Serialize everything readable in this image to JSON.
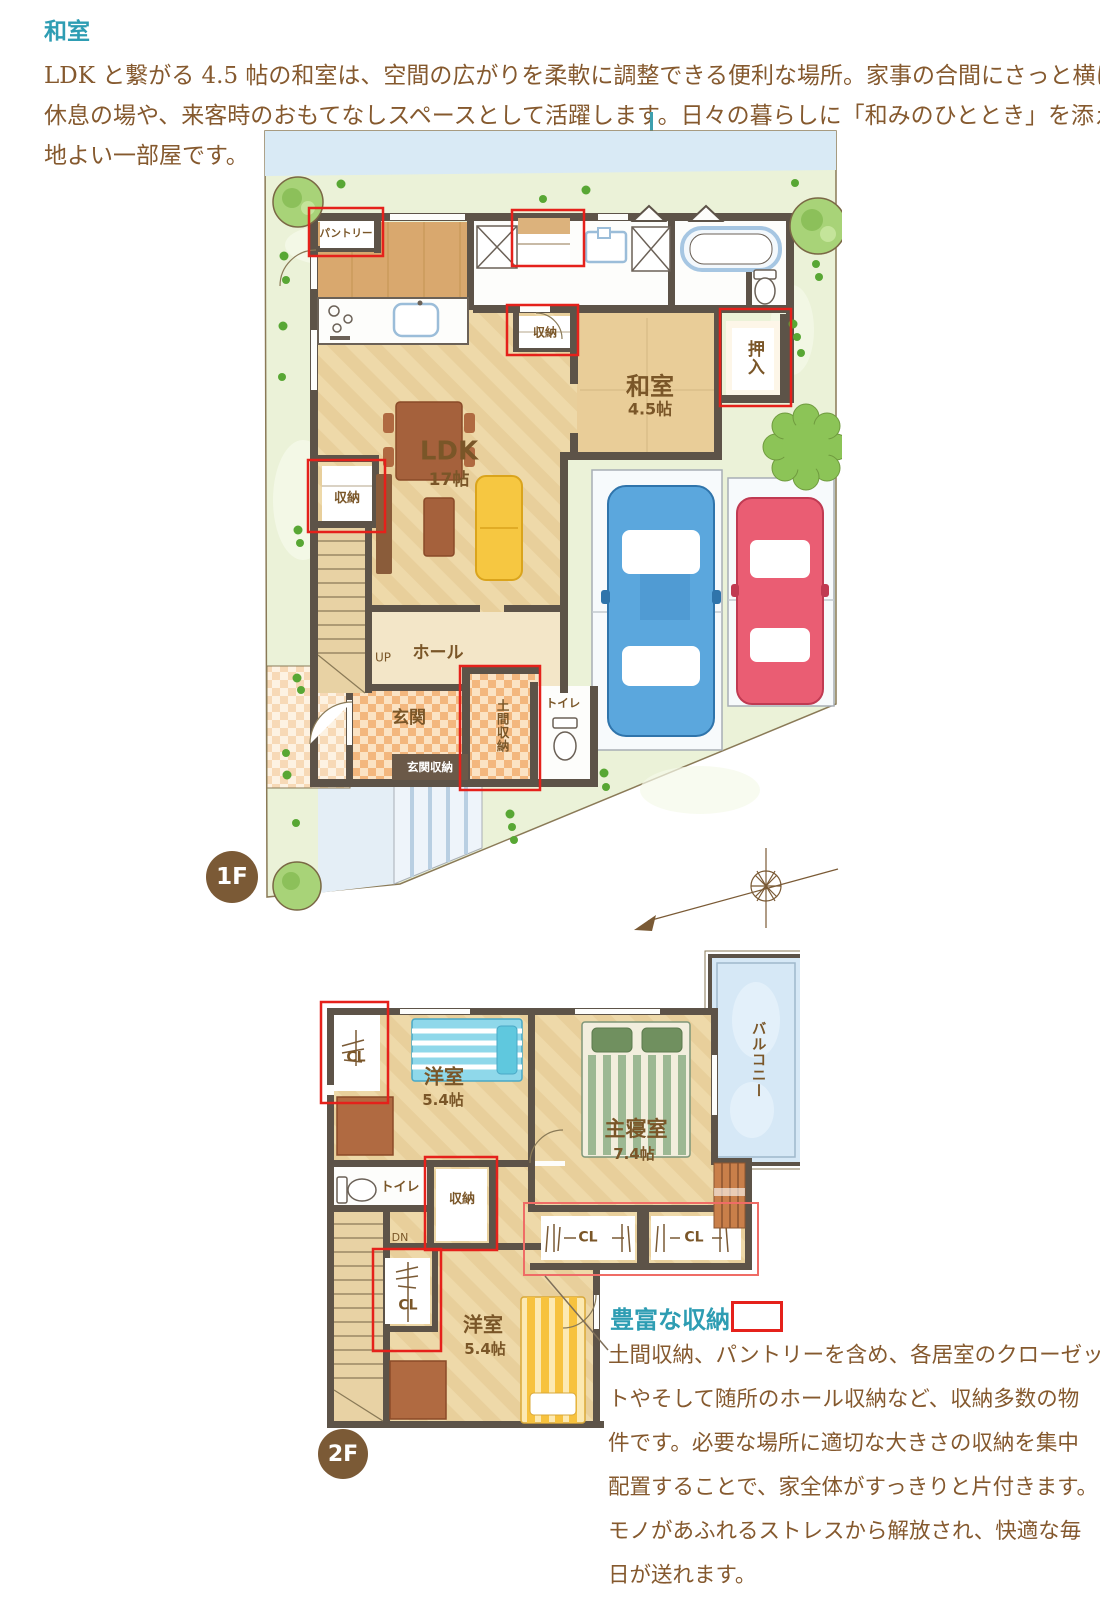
{
  "header": {
    "heading": "和室",
    "lines": [
      "LDK と繋がる 4.5 帖の和室は、空間の広がりを柔軟に調整できる便利な場所。家事の合間にさっと横になれる",
      "休息の場や、来客時のおもてなしスペースとして活躍します。日々の暮らしに「和みのひととき」を添える心",
      "地よい一部屋です。"
    ]
  },
  "callout": {
    "heading": "豊富な収納",
    "lines": [
      "土間収納、パントリーを含め、各居室のクローゼッ",
      "トやそして随所のホール収納など、収納多数の物",
      "件です。必要な場所に適切な大きさの収納を集中",
      "配置することで、家全体がすっきりと片付きます。",
      "モノがあふれるストレスから解放され、快適な毎",
      "日が送れます。"
    ]
  },
  "floor1": {
    "badge": "1F",
    "labels": {
      "pantry": "パントリー",
      "closet_mid": "収納",
      "closet_left": "収納",
      "oshiire": "押入",
      "washitsu": "和室",
      "washitsu_size": "4.5帖",
      "ldk": "LDK",
      "ldk_size": "17帖",
      "up": "UP",
      "hall": "ホール",
      "genkan": "玄関",
      "genkan_storage": "玄関収納",
      "doma_storage": "土間収納",
      "toilet": "トイレ"
    }
  },
  "floor2": {
    "badge": "2F",
    "labels": {
      "cl_top": "CL",
      "room1": "洋室",
      "room1_size": "5.4帖",
      "master": "主寝室",
      "master_size": "7.4帖",
      "balcony": "バルコニー",
      "toilet": "トイレ",
      "closet": "収納",
      "dn": "DN",
      "cl_bottom": "CL",
      "cl_master_left": "CL",
      "cl_master_right": "CL",
      "room2": "洋室",
      "room2_size": "5.4帖"
    }
  },
  "colors": {
    "accent_teal": "#2e9db3",
    "annotation_red": "#e5211b",
    "badge_brown": "#7b5a36",
    "body_text_brown": "#85592e",
    "wall": "#5d5348",
    "floor_tan": "#eed9a9",
    "kitchen_wood": "#d9a86e",
    "grass_green": "#ebf2d8",
    "water_blue": "#d9eaf5",
    "car_blue": "#5ba7dd",
    "car_red": "#ea5d73",
    "sofa_yellow": "#f6c741",
    "bed_cyan": "#8fd8ea",
    "bed_green": "#9cb893",
    "bed_yellow": "#f7c23e",
    "balcony_blue": "#d6e8f6"
  }
}
